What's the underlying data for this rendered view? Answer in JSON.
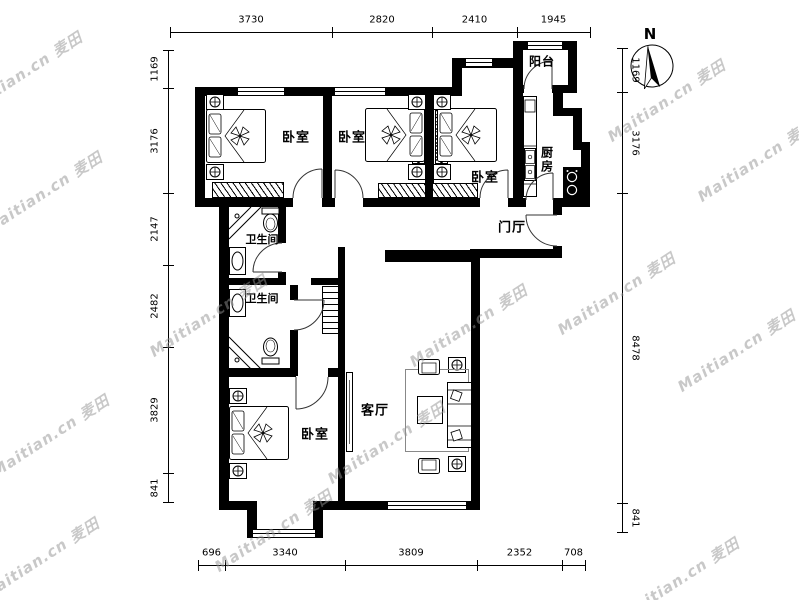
{
  "compass": {
    "label": "N"
  },
  "watermark": {
    "text": "Maitian.cn 麦田"
  },
  "rooms": {
    "bedroom1": "卧室",
    "bedroom2": "卧室",
    "bedroom3": "卧室",
    "bedroom4": "卧室",
    "living": "客厅",
    "kitchen": "厨房",
    "balcony": "阳台",
    "hall": "门厅",
    "bath1": "卫生间",
    "bath2": "卫生间"
  },
  "dimensions": {
    "top": [
      "3730",
      "2820",
      "2410",
      "1945"
    ],
    "bottom": [
      "696",
      "3340",
      "3809",
      "2352",
      "708"
    ],
    "left": [
      "1169",
      "3176",
      "2147",
      "2482",
      "3829",
      "841"
    ],
    "right": [
      "1169",
      "3176",
      "8478",
      "841"
    ]
  },
  "colors": {
    "wall": "#000000",
    "line": "#333333",
    "watermark": "#919191"
  }
}
